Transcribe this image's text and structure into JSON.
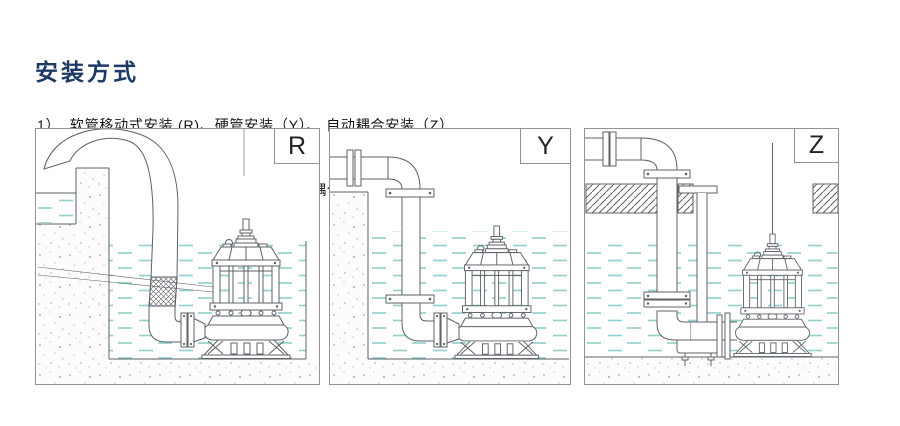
{
  "header": {
    "title": "安装方式",
    "notes": [
      "1）  软管移动式安装 (R)、硬管安装（Y）、 自动耦合安装（Z）",
      "2）自动耦合安装时，我们将提供耦合座、耦合块、上导架等成套装置与电泵配套。"
    ]
  },
  "diagrams": [
    {
      "label": "R"
    },
    {
      "label": "Y"
    },
    {
      "label": "Z"
    }
  ],
  "colors": {
    "title": "#1d3a66",
    "text": "#141414",
    "line": "#5c6166",
    "border": "#8f9396",
    "water": "#93d2cf",
    "speckle-dark": "#a7abae",
    "speckle-light": "#c8cbcd",
    "label": "#222222",
    "page-bg": "#ffffff"
  }
}
